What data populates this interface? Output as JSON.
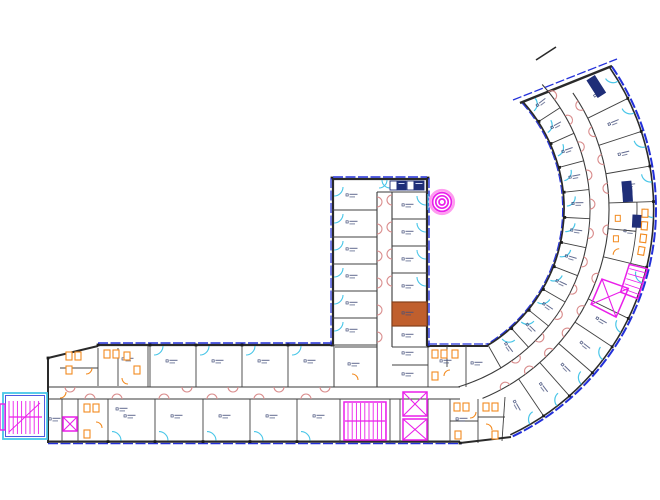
{
  "document": {
    "type": "architectural-floor-plan",
    "visible_text": "room labels illegible at this scale"
  },
  "canvas": {
    "w": 660,
    "h": 500,
    "bg": "#ffffff"
  },
  "palette": {
    "wall": "#2a2a2a",
    "partition": "#404040",
    "corridor_wall": "#3a3a3a",
    "ext_blue": "#2330d9",
    "glass": "#49c6e8",
    "door_int": "#d98c8c",
    "door_orange": "#f28a1f",
    "highlight": "#ea1fea",
    "highlight_soft": "#ff9bf0",
    "fixture": "#f28a1f",
    "navy": "#1f2e78",
    "room_fill": "#c05f2d",
    "room_fill_edge": "#84401a",
    "label": "#46517c",
    "column": "#1c1c1c",
    "stair_cyan": "#49c6e8"
  },
  "curve": {
    "cx": 404,
    "cy": 209,
    "r_out": 252,
    "r_out_black": 249.6,
    "r_c2": 205,
    "r_c1": 186,
    "r_in": 160,
    "r_in_blue": 158.6,
    "r_in_hinge": 162.6,
    "a_tip_out": -34.5,
    "a_tip_in": -42,
    "a_end_out": 64.8,
    "a_end_in": 58.5,
    "a_end_c1": 73,
    "a_end_c2": 67.5,
    "outer_parts": [
      -26.3,
      -18.1,
      -9.9,
      -1.7,
      13.5,
      26,
      33.5,
      41,
      48.5,
      56
    ],
    "inner_parts": [
      -33,
      -24,
      -15,
      -6,
      3,
      12,
      21,
      30,
      39,
      48
    ],
    "restroom_span": [
      -1.7,
      13.5
    ],
    "hl_elevator": {
      "a1": 19.5,
      "a2": 27,
      "r1": 210,
      "r2": 238
    },
    "hl_stair": {
      "a1": 13.8,
      "a2": 21,
      "r1": 232,
      "r2": 250.5
    },
    "end_wall": [
      520,
      103,
      612,
      66
    ],
    "end_glass": [
      513,
      100,
      617,
      59
    ],
    "tip_tick": [
      536,
      60,
      556,
      47
    ]
  },
  "h_wing": {
    "top_black": 345,
    "top_blue": 343,
    "bot_black": 441.6,
    "bot_blue": 443.6,
    "cor1": 387,
    "cor2": 399,
    "x_west": 48,
    "x_east": 460,
    "slant": [
      48,
      358,
      98,
      346
    ],
    "upper_rooms": [
      150,
      196,
      242,
      288
    ],
    "upper_w": 46,
    "upper_y": 346,
    "upper_h": 41,
    "lower_rooms": [
      108,
      155,
      203,
      250,
      297
    ],
    "lower_w": 47,
    "lower_y": 399,
    "lower_h": 44
  },
  "v_wing": {
    "x1": 332,
    "x2": 428,
    "top": 178,
    "bot": 346,
    "cor1": 377,
    "cor2": 392,
    "left_rooms": [
      183,
      210,
      237,
      264,
      291,
      318
    ],
    "left_last_bot": 345,
    "right_rooms": [
      192,
      219,
      246,
      273
    ],
    "band_y": 192,
    "orange_room": [
      392,
      302,
      35,
      24
    ],
    "below_orange": [
      392,
      326,
      35,
      21
    ]
  },
  "extra_walls": [
    [
      48,
      358,
      48,
      443,
      2
    ],
    [
      48,
      358,
      98,
      346,
      2
    ],
    [
      148,
      346,
      148,
      387,
      1
    ],
    [
      62,
      399,
      62,
      443,
      1
    ],
    [
      78,
      399,
      78,
      443,
      1
    ],
    [
      98,
      348,
      98,
      386,
      1
    ],
    [
      118,
      348,
      118,
      386,
      1
    ],
    [
      60,
      368,
      98,
      368,
      1
    ],
    [
      334,
      345,
      334,
      387,
      1
    ],
    [
      335,
      347,
      377,
      347,
      1
    ],
    [
      392,
      347,
      428,
      347,
      1
    ],
    [
      392,
      365,
      428,
      365,
      1
    ],
    [
      340,
      399,
      340,
      443,
      1
    ],
    [
      390,
      399,
      390,
      443,
      1
    ],
    [
      400,
      399,
      400,
      443,
      1
    ],
    [
      428,
      399,
      428,
      443,
      1
    ],
    [
      428,
      346,
      428,
      387,
      1
    ],
    [
      466,
      346,
      466,
      387,
      1
    ],
    [
      447,
      346,
      447,
      367,
      1
    ],
    [
      450,
      399,
      450,
      443,
      1
    ],
    [
      478,
      399,
      478,
      443,
      1
    ],
    [
      450,
      421,
      478,
      421,
      1
    ],
    [
      478,
      417,
      505,
      417,
      1
    ],
    [
      505,
      397,
      502,
      441,
      1
    ],
    [
      488,
      345,
      501,
      368,
      1
    ],
    [
      460,
      443,
      511,
      437,
      2
    ]
  ],
  "stairs": {
    "s1_room": [
      3,
      393,
      44,
      46
    ],
    "s1_treads": [
      9,
      401,
      33,
      33
    ],
    "s1_strip": [
      0,
      404,
      5,
      26
    ],
    "s2_area": [
      344,
      402,
      42,
      38
    ]
  },
  "elevators": [
    [
      63,
      417,
      14,
      14
    ],
    [
      403,
      392,
      24,
      24
    ],
    [
      403,
      419,
      24,
      21
    ]
  ],
  "restroom_fixtures": [
    [
      66,
      352
    ],
    [
      75,
      352
    ],
    [
      104,
      350
    ],
    [
      113,
      350
    ],
    [
      124,
      352
    ],
    [
      66,
      366
    ],
    [
      134,
      366
    ],
    [
      84,
      404
    ],
    [
      93,
      404
    ],
    [
      84,
      430
    ],
    [
      432,
      350
    ],
    [
      441,
      350
    ],
    [
      452,
      350
    ],
    [
      432,
      372
    ],
    [
      454,
      403
    ],
    [
      463,
      403
    ],
    [
      483,
      403
    ],
    [
      492,
      403
    ],
    [
      455,
      431
    ],
    [
      492,
      431
    ]
  ],
  "orange_arcs": [
    [
      86,
      368,
      "se"
    ],
    [
      128,
      378,
      "sw"
    ],
    [
      96,
      428,
      "ne"
    ],
    [
      450,
      376,
      "nw"
    ],
    [
      470,
      412,
      "se"
    ],
    [
      486,
      430,
      "ne"
    ],
    [
      352,
      380,
      "ne"
    ],
    [
      60,
      392,
      "se"
    ]
  ],
  "curve_fixture_angles": [
    1,
    4,
    7,
    10
  ],
  "curve_fixture_angles2": [
    2.5,
    8
  ],
  "navy_boxes": [
    {
      "x": 390,
      "y": 181,
      "w": 7,
      "h": 9,
      "fill": false
    },
    {
      "x": 397,
      "y": 181,
      "w": 9,
      "h": 9,
      "fill": true
    },
    {
      "x": 407,
      "y": 181,
      "w": 7,
      "h": 9,
      "fill": false
    },
    {
      "x": 414,
      "y": 181,
      "w": 10,
      "h": 9,
      "fill": true
    }
  ],
  "navy_polar": [
    {
      "a": -32.5,
      "r": 228,
      "w": 20,
      "h": 9
    },
    {
      "a": -5.5,
      "r": 224,
      "w": 12,
      "h": 9
    },
    {
      "a": -3.6,
      "r": 224,
      "w": 13,
      "h": 9
    },
    {
      "a": 3,
      "r": 233,
      "w": 12,
      "h": 8
    }
  ],
  "spiral": {
    "cx": 442,
    "cy": 202,
    "radii": [
      3,
      6.2,
      9.4
    ],
    "halo": 11.8
  },
  "columns_extra": [
    [
      48,
      358
    ],
    [
      98,
      345
    ],
    [
      332,
      178
    ],
    [
      428,
      178
    ],
    [
      332,
      345
    ],
    [
      428,
      346
    ],
    [
      460,
      443
    ]
  ]
}
